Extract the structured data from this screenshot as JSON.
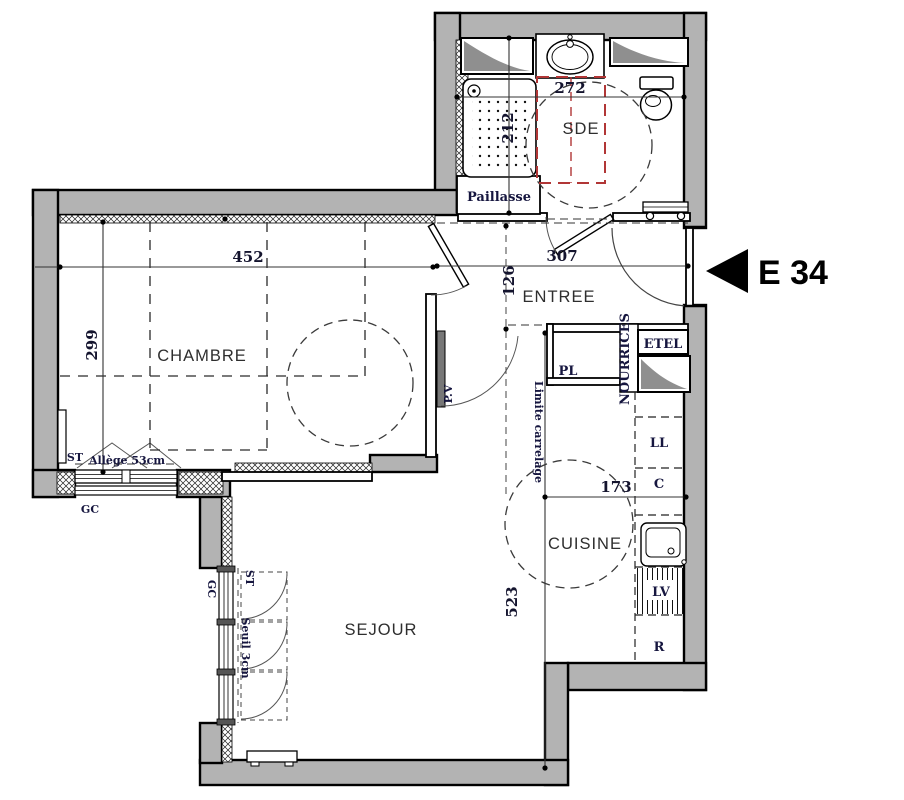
{
  "unit": {
    "label": "E 34"
  },
  "rooms": {
    "bathroom": "SDE",
    "entry": "ENTREE",
    "bedroom": "CHAMBRE",
    "kitchen": "CUISINE",
    "living": "SEJOUR"
  },
  "dimensions_cm": {
    "bedroom_width": "452",
    "bedroom_depth": "299",
    "bathroom_width": "272",
    "bathroom_depth": "212",
    "entry_width": "307",
    "entry_depth": "126",
    "kitchen_worktop": "173",
    "living_depth": "523"
  },
  "labels": {
    "counter": "Paillasse",
    "closet": "PL",
    "etel": "ETEL",
    "manifolds": "NOURRICES",
    "washing_machine": "LL",
    "cooker": "C",
    "dishwasher": "LV",
    "fridge": "R",
    "sill_height": "Allège 53cm",
    "threshold": "Seuil 3cm",
    "glazed_door": "P.V",
    "tile_limit": "Limite carrelage",
    "st_bedroom": "ST",
    "gc_bedroom": "GC",
    "st_living": "ST",
    "gc_living": "GC"
  },
  "colors": {
    "wall_fill": "#b3b3b3",
    "accessibility_red": "#b13636",
    "label_navy": "#16163f",
    "line_dark": "#1a1a1a"
  }
}
